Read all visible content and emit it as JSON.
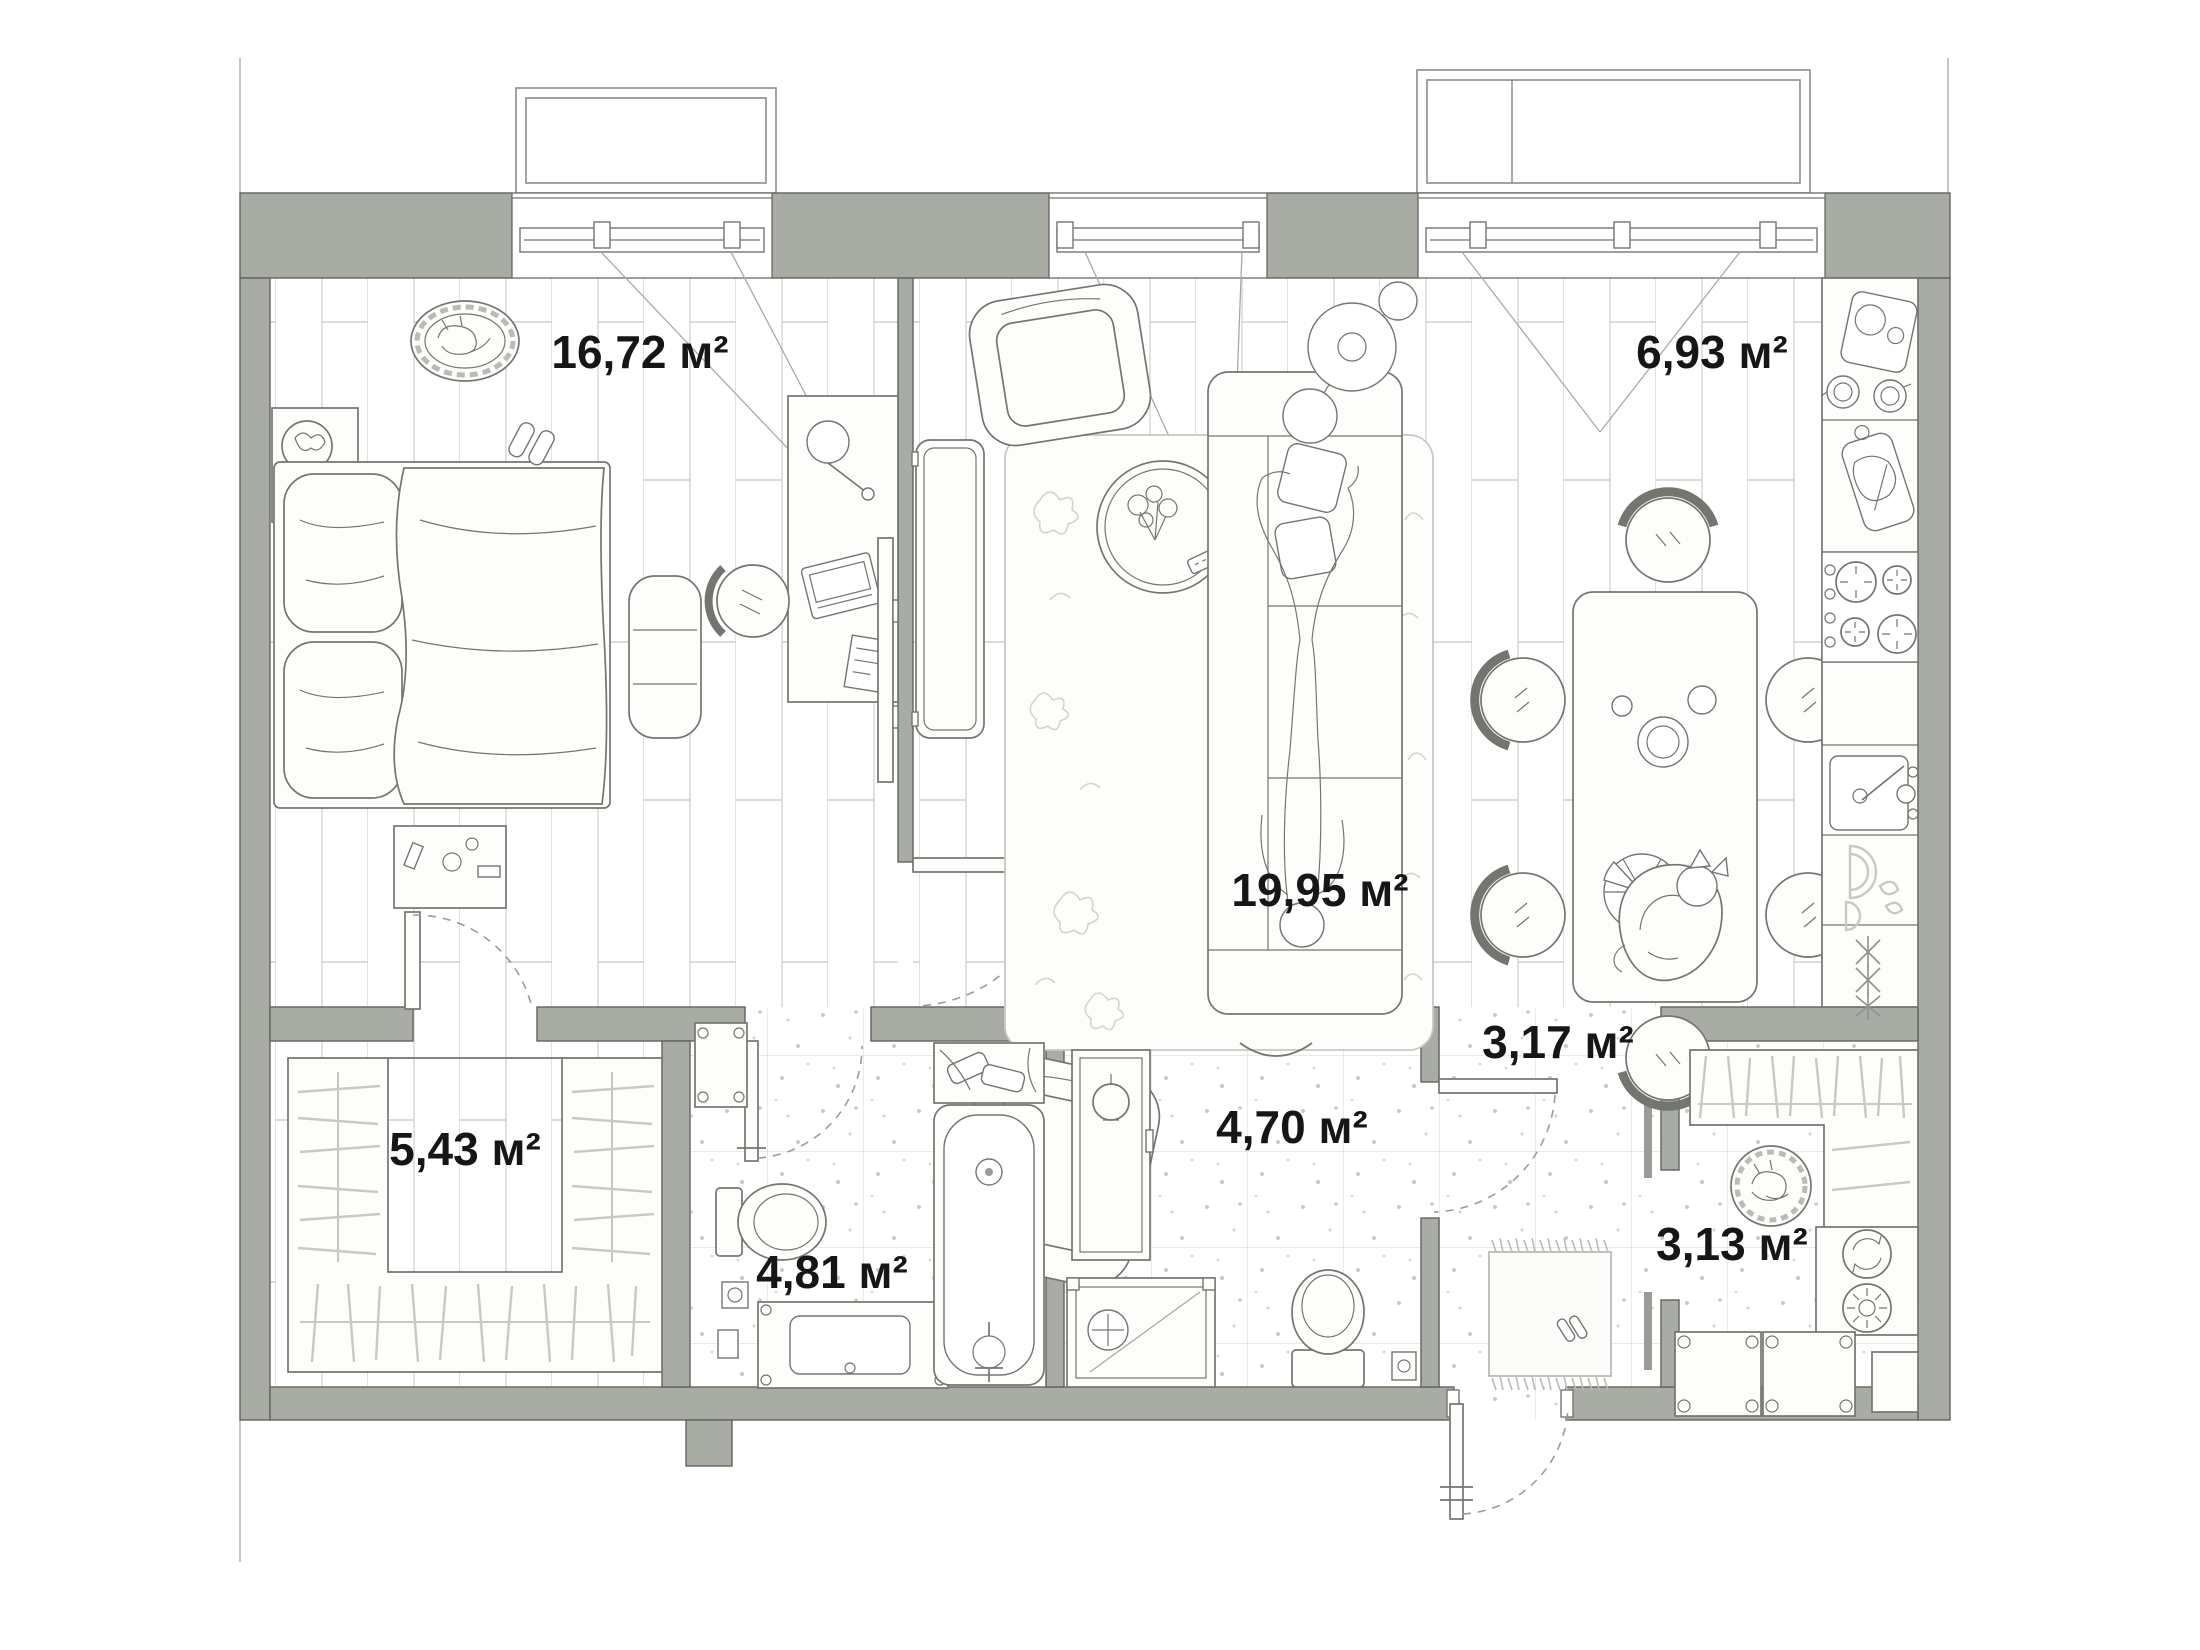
{
  "plan": {
    "type": "apartment-floor-plan",
    "area_unit": "м²",
    "rooms": [
      {
        "id": "bedroom",
        "area_label": "16,72 м²"
      },
      {
        "id": "living-room",
        "area_label": "19,95 м²"
      },
      {
        "id": "kitchen-dining",
        "area_label": "6,93 м²"
      },
      {
        "id": "wardrobe-room",
        "area_label": "5,43 м²"
      },
      {
        "id": "bathroom",
        "area_label": "4,81 м²"
      },
      {
        "id": "shower-room",
        "area_label": "4,70 м²"
      },
      {
        "id": "hallway",
        "area_label": "3,17 м²"
      },
      {
        "id": "laundry-storage",
        "area_label": "3,13 м²"
      }
    ],
    "colors": {
      "background": "#ffffff",
      "wall_fill": "#a9aca4",
      "wall_outline": "#61645e",
      "furniture_line": "#73766f",
      "light_line": "#c7cac4",
      "floor_line": "#d8d8d4",
      "label_text": "#161616"
    }
  }
}
